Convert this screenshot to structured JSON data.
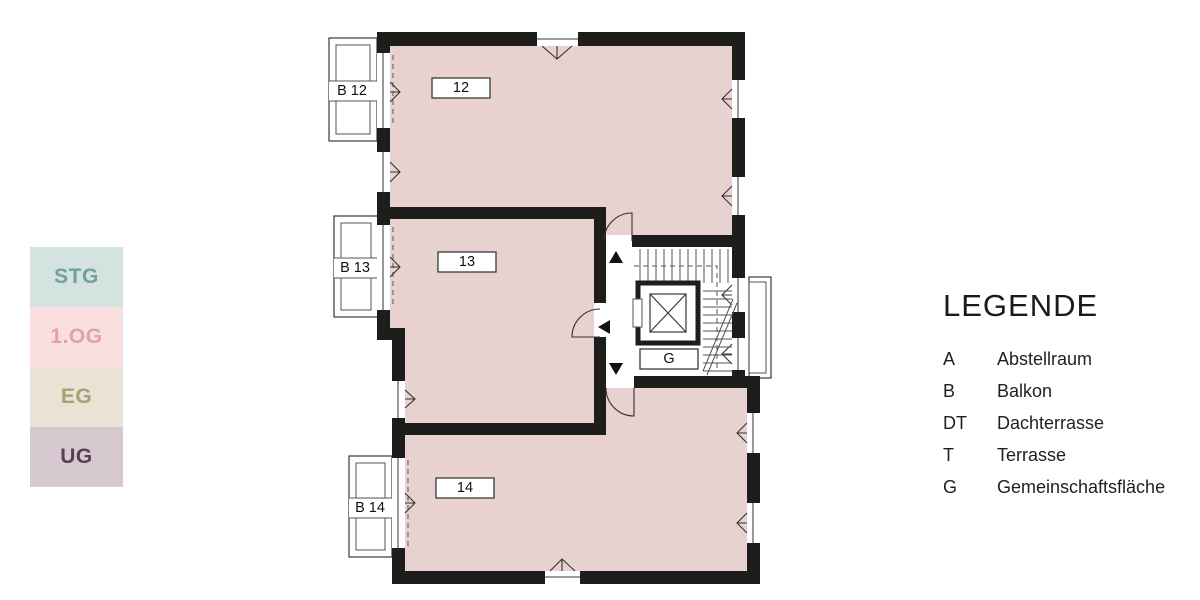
{
  "floor_selector": {
    "items": [
      {
        "label": "STG",
        "bg": "#d4e2e0",
        "color": "#72a09d"
      },
      {
        "label": "1.OG",
        "bg": "#f9e0de",
        "color": "#e0a4a1"
      },
      {
        "label": "EG",
        "bg": "#e8e3d4",
        "color": "#a6a274"
      },
      {
        "label": "UG",
        "bg": "#d7c9d0",
        "color": "#5d3e51"
      }
    ]
  },
  "legend": {
    "title": "LEGENDE",
    "entries": [
      {
        "abbr": "A",
        "term": "Abstellraum"
      },
      {
        "abbr": "B",
        "term": "Balkon"
      },
      {
        "abbr": "DT",
        "term": "Dachterrasse"
      },
      {
        "abbr": "T",
        "term": "Terrasse"
      },
      {
        "abbr": "G",
        "term": "Gemeinschaftsfläche"
      }
    ]
  },
  "plan": {
    "room_labels": [
      "12",
      "13",
      "14"
    ],
    "balcony_labels": [
      "B 12",
      "B 13",
      "B 14"
    ],
    "core_label": "G",
    "colors": {
      "room_fill": "#e7d2d0",
      "wall": "#1d1d1b"
    }
  }
}
